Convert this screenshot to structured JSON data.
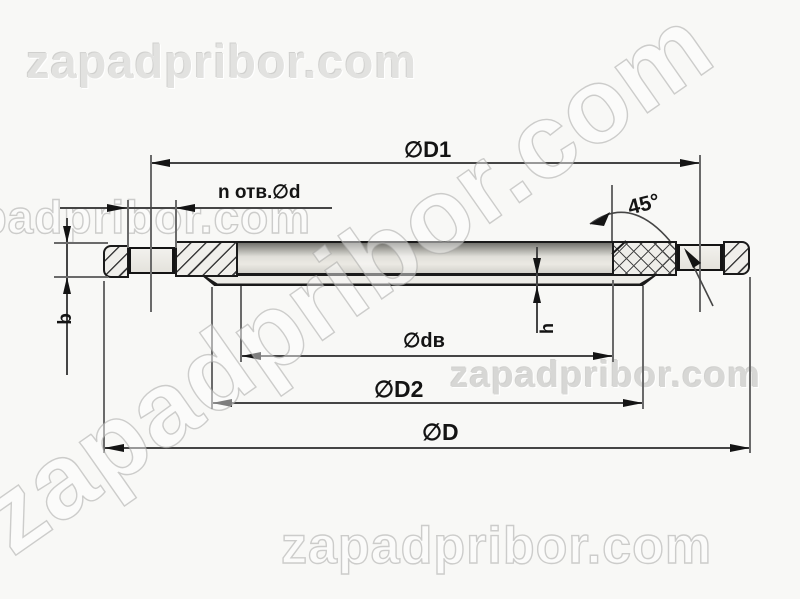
{
  "watermark": {
    "text": "zapadpribor.com"
  },
  "dimensions": {
    "d1_label": "∅D1",
    "holes_label": "n отв.∅d",
    "angle_label": "45°",
    "bore_label": "∅dв",
    "d2_label": "∅D2",
    "outer_label": "∅D",
    "thickness_label": "b",
    "boss_height_label": "h"
  },
  "colors": {
    "background": "#f8f8f6",
    "object_line": "#1a1a1a",
    "dimension_line": "#454545",
    "watermark": "#d8d8d6"
  }
}
